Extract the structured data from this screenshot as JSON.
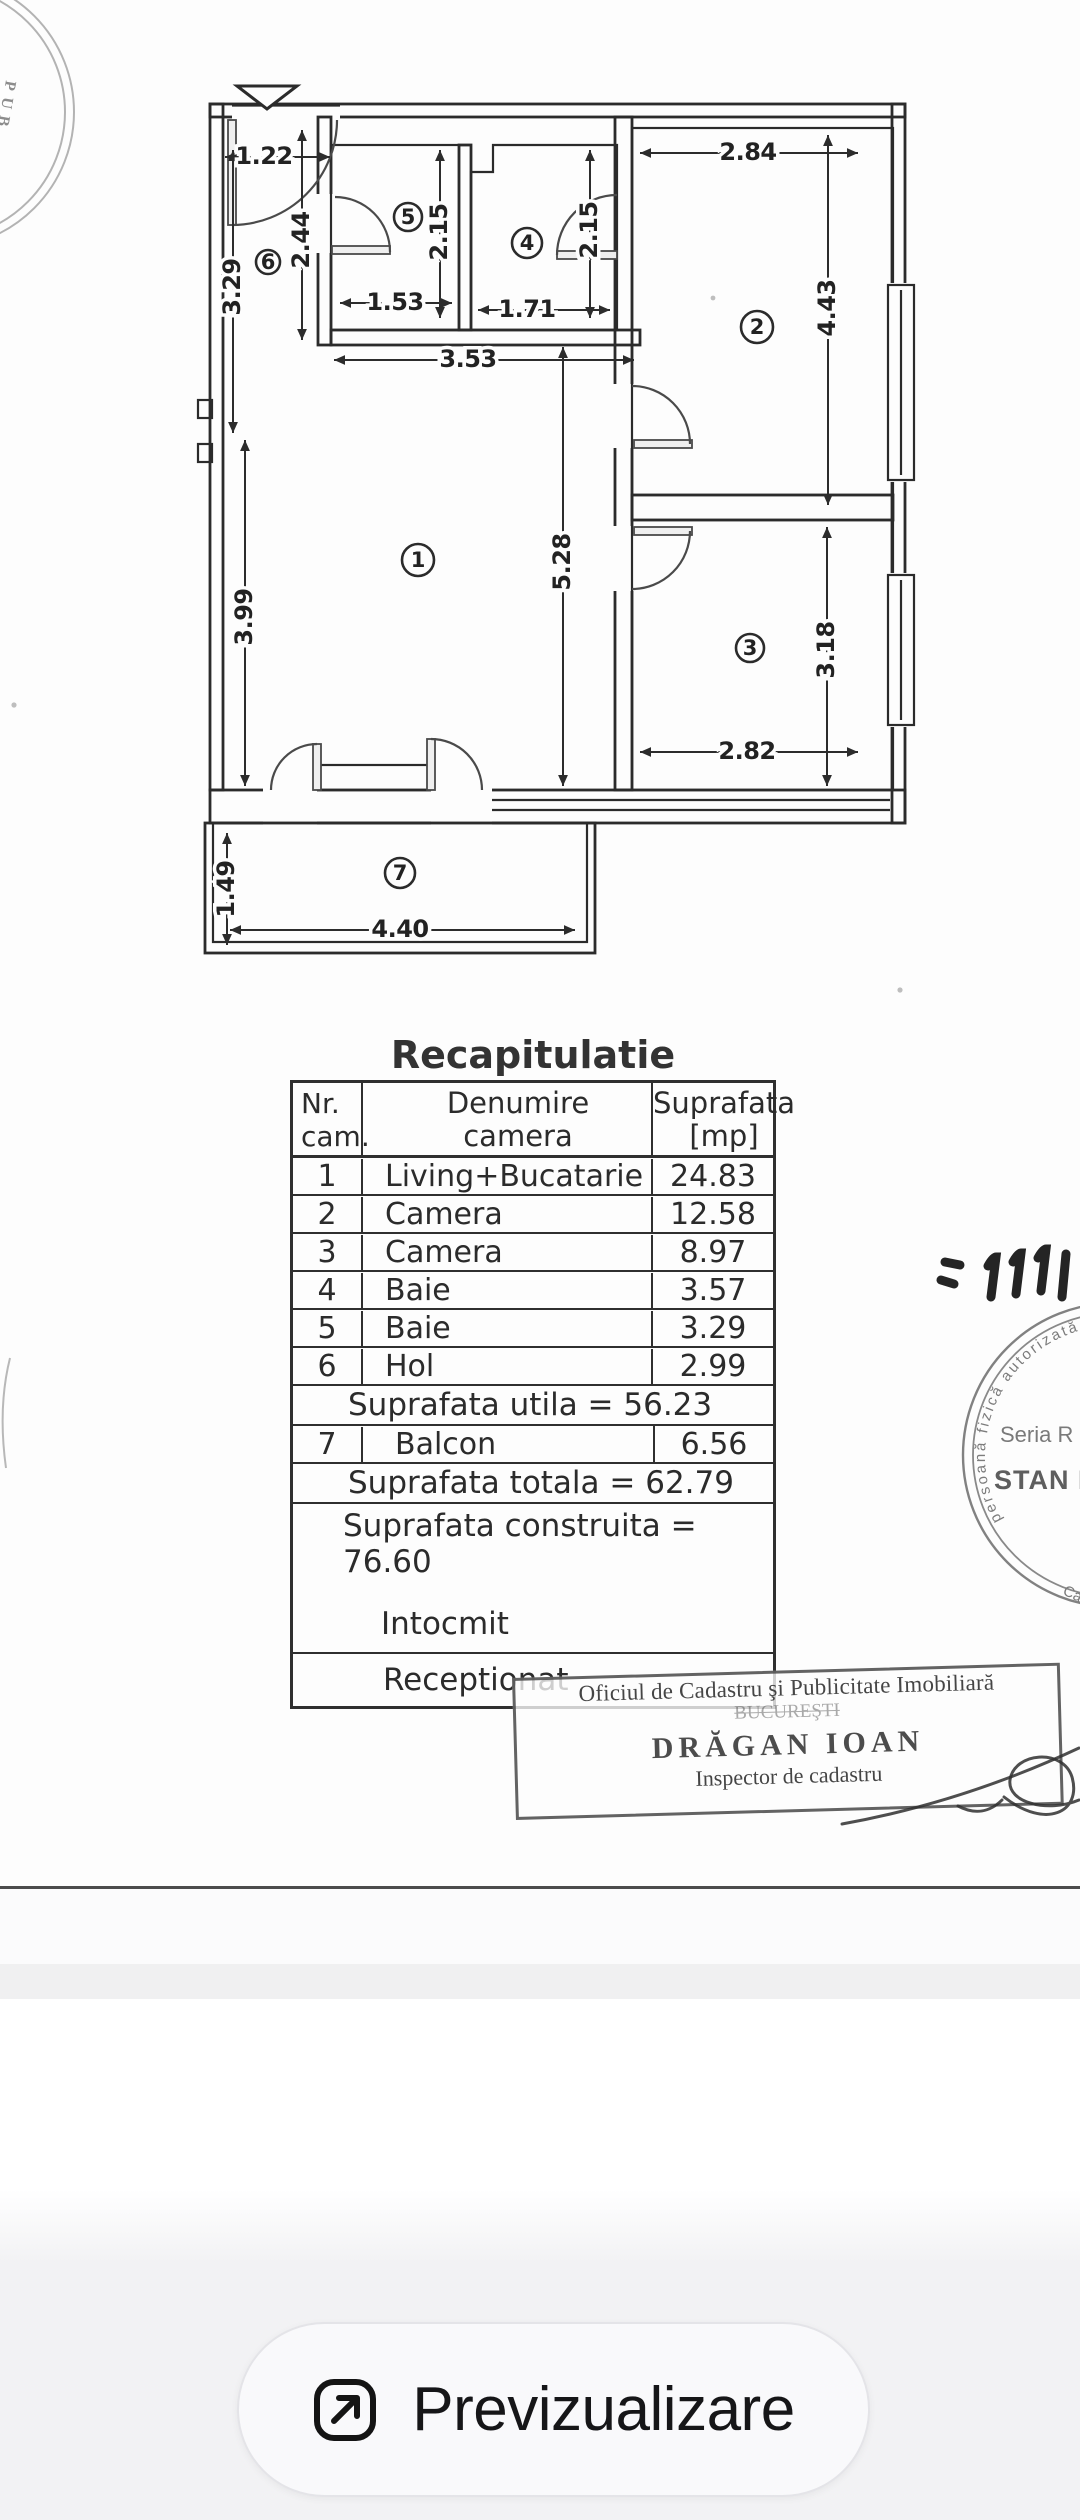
{
  "plan": {
    "room_numbers": [
      "1",
      "2",
      "3",
      "4",
      "5",
      "6",
      "7"
    ],
    "dims": [
      "1.22",
      "2.44",
      "3.29",
      "1.53",
      "2.15",
      "1.71",
      "2.15",
      "2.84",
      "4.43",
      "3.53",
      "5.28",
      "3.99",
      "3.18",
      "2.82",
      "1.49",
      "4.40"
    ]
  },
  "recap": {
    "title": "Recapitulatie",
    "header": {
      "col1a": "Nr.",
      "col1b": "cam.",
      "col2a": "Denumire",
      "col2b": "camera",
      "col3a": "Suprafata",
      "col3b": "[mp]"
    },
    "rows": [
      {
        "nr": "1",
        "name": "Living+Bucatarie",
        "area": "24.83"
      },
      {
        "nr": "2",
        "name": "Camera",
        "area": "12.58"
      },
      {
        "nr": "3",
        "name": "Camera",
        "area": "8.97"
      },
      {
        "nr": "4",
        "name": "Baie",
        "area": "3.57"
      },
      {
        "nr": "5",
        "name": "Baie",
        "area": "3.29"
      },
      {
        "nr": "6",
        "name": "Hol",
        "area": "2.99"
      }
    ],
    "utila": "Suprafata utila = 56.23",
    "balcon": {
      "nr": "7",
      "name": "Balcon",
      "area": "6.56"
    },
    "totala": "Suprafata totala = 62.79",
    "construita": "Suprafata construita = 76.60",
    "intocmit": "Intocmit",
    "receptionat": "Receptionat"
  },
  "office_stamp": {
    "line1": "Oficiul de Cadastru şi Publicitate Imobiliară",
    "line2": "BUCUREŞTI",
    "line3": "DRĂGAN IOAN",
    "line4": "Inspector de cadastru"
  },
  "round_stamp": {
    "ring_text": "persoană fizică autorizată de ANCPI",
    "line1": "Seria R",
    "line2": "STAN L",
    "bottom": "Ca"
  },
  "margin_stamp": {
    "text": "PUB"
  },
  "preview_button": {
    "label": "Previzualizare"
  }
}
